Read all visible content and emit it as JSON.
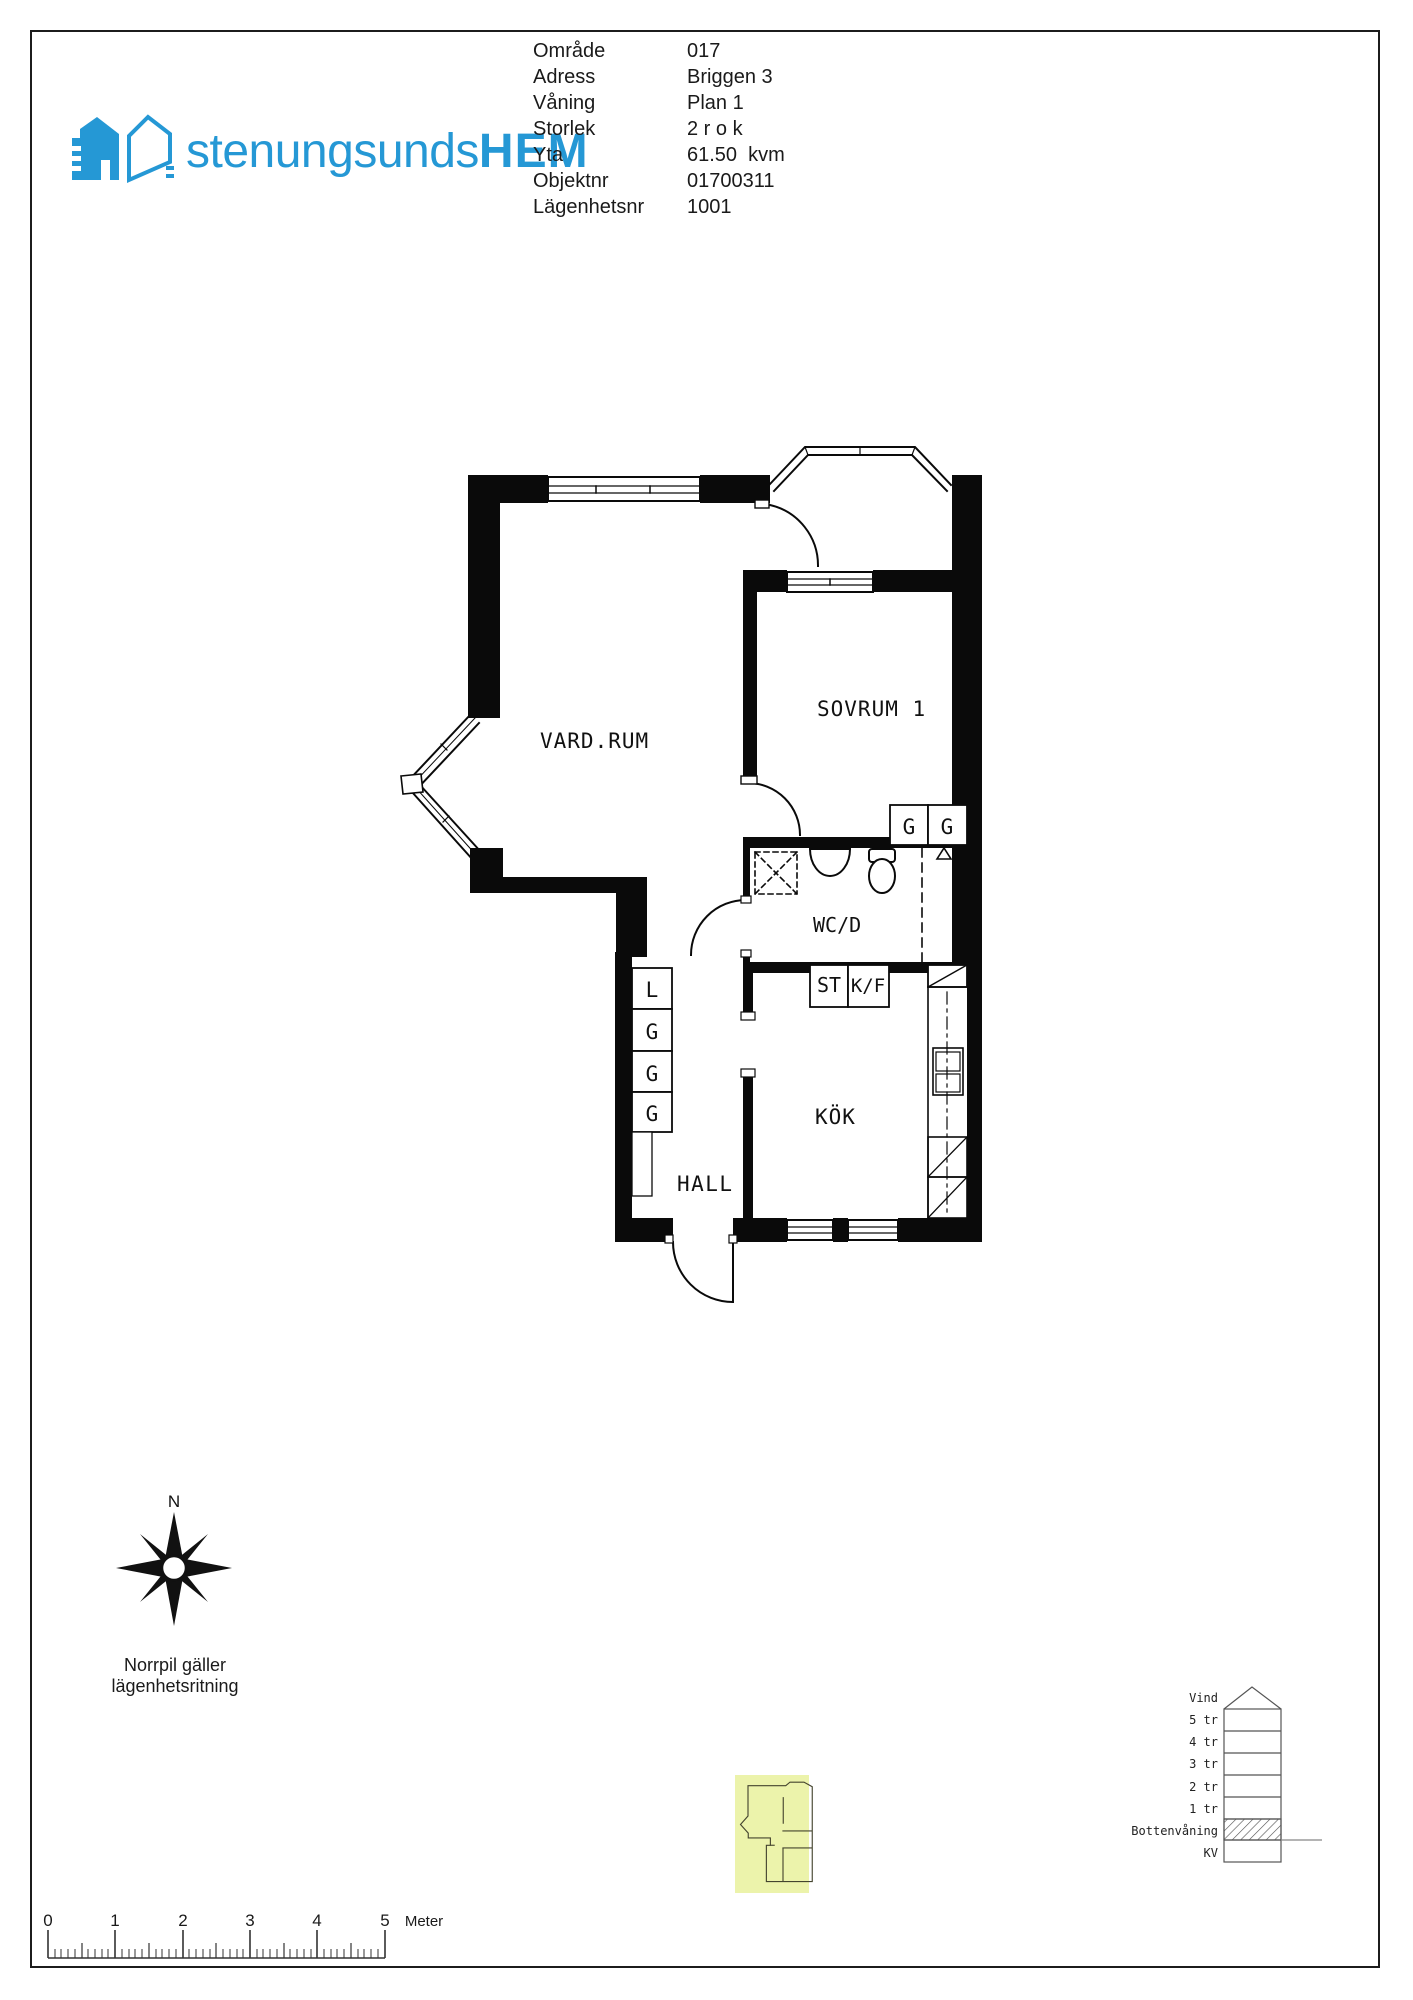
{
  "page": {
    "bg": "#ffffff",
    "border_color": "#1c1c1c",
    "ink": "#111111"
  },
  "logo": {
    "text_light": "stenungsunds",
    "text_bold": "HEM",
    "brand_color": "#2598d5"
  },
  "info": {
    "rows": [
      {
        "label": "Område",
        "value": "017"
      },
      {
        "label": "Adress",
        "value": "Briggen 3"
      },
      {
        "label": "Våning",
        "value": "Plan 1"
      },
      {
        "label": "Storlek",
        "value": "2 r o k"
      },
      {
        "label": "Yta",
        "value": "61.50  kvm"
      },
      {
        "label": "Objektnr",
        "value": "01700311"
      },
      {
        "label": "Lägenhetsnr",
        "value": "1001"
      }
    ]
  },
  "floor_plan": {
    "rooms": {
      "vardagsrum": "VARD.RUM",
      "sovrum": "SOVRUM 1",
      "wc": "WC/D",
      "kok": "KÖK",
      "hall": "HALL"
    },
    "hall_closets": [
      "L",
      "G",
      "G",
      "G"
    ],
    "sovrum_closets": [
      "G",
      "G"
    ],
    "kitchen_units": {
      "st": "ST",
      "kf": "K/F"
    }
  },
  "compass": {
    "north": "N",
    "caption_line1": "Norrpil gäller",
    "caption_line2": "lägenhetsritning"
  },
  "building": {
    "floors": [
      {
        "label": "Vind"
      },
      {
        "label": "5 tr"
      },
      {
        "label": "4 tr"
      },
      {
        "label": "3 tr"
      },
      {
        "label": "2 tr"
      },
      {
        "label": "1 tr"
      },
      {
        "label": "Bottenvåning",
        "highlighted": true
      },
      {
        "label": "KV"
      }
    ]
  },
  "scale_bar": {
    "labels": [
      "0",
      "1",
      "2",
      "3",
      "4",
      "5"
    ],
    "unit": "Meter"
  },
  "mini_plan": {
    "highlight_color": "#ecf3ab"
  }
}
